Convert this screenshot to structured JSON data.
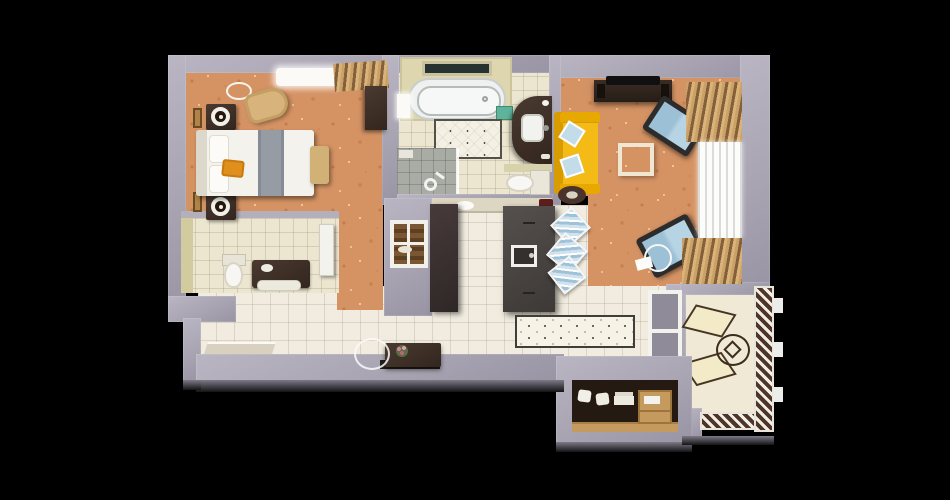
{
  "scene": {
    "type": "apartment-floor-plan-3d-top-view",
    "background_color": "#000000",
    "palette": {
      "exterior_wall": "#a8a4b2",
      "bedroom_living_carpet": "#d59364",
      "hall_kitchen_tile": "#f1ecdf",
      "bathroom_tile": "#ece6d0",
      "bathroom_cut_wall": "#ddd6ae",
      "sofa_yellow": "#f2b200",
      "armchair_blue": "#a9cadd",
      "pillow_blue": "#c2dcea",
      "dark_furniture": "#3b2d24",
      "island_grey": "#4a4543",
      "wardrobe_wood": "#c59a5e",
      "railing_brown": "#4f3527",
      "bed_orange_accent": "#e08f1c"
    },
    "rooms": [
      {
        "id": "bedroom",
        "name": "bedroom",
        "floor": "orange speckled carpet",
        "furniture": [
          "double bed with grey runner and orange towel",
          "headboard",
          "two dark nightstands",
          "two round table lamps",
          "two gold wall frames",
          "tan armchair",
          "foot bench",
          "dark dresser",
          "ceiling light",
          "window with sheer curtain",
          "wooden blinds"
        ]
      },
      {
        "id": "bathroom",
        "name": "main bathroom",
        "floor": "cream tile",
        "furniture": [
          "bathtub in alcove",
          "window above tub",
          "glass shower corner with shower head",
          "curved dark vanity with sink",
          "teal soap box",
          "quilted dotted rug",
          "toilet with tank"
        ]
      },
      {
        "id": "guest-wc",
        "name": "guest wc",
        "floor": "cream tile",
        "furniture": [
          "toilet",
          "dark vanity with white tray",
          "white door leaf"
        ]
      },
      {
        "id": "kitchen",
        "name": "kitchen",
        "floor": "white tile",
        "furniture": [
          "tall dark cabinet",
          "dark island with inset sink",
          "three blue dining chairs",
          "counter with dish and red coffee machine",
          "pass-through window with wooden shelves"
        ]
      },
      {
        "id": "living-room",
        "name": "living room",
        "floor": "orange speckled carpet",
        "furniture": [
          "dark tv console",
          "flat tv",
          "yellow sofa with two blue pillows",
          "square coffee table",
          "two blue lounge chairs",
          "floor lamp with paper",
          "small dark round rug",
          "side window with wooden blinds and white curtain"
        ]
      },
      {
        "id": "hallway",
        "name": "hallway",
        "floor": "white tile",
        "furniture": [
          "dark console table with pink flowers",
          "round leaning mirror",
          "dark mat",
          "dotted runner rug",
          "entry landing"
        ]
      },
      {
        "id": "closet",
        "name": "closet",
        "floor": "dark wardrobe interior",
        "furniture": [
          "wooden wardrobe with shelves",
          "white pillows",
          "folded linens",
          "wooden drawer unit"
        ]
      },
      {
        "id": "balcony",
        "name": "balcony",
        "floor": "cream screed",
        "furniture": [
          "two outlined sun loungers",
          "round table with cube sketch",
          "diagonal-hatched railing",
          "three white balusters",
          "window to kitchen"
        ]
      }
    ]
  }
}
